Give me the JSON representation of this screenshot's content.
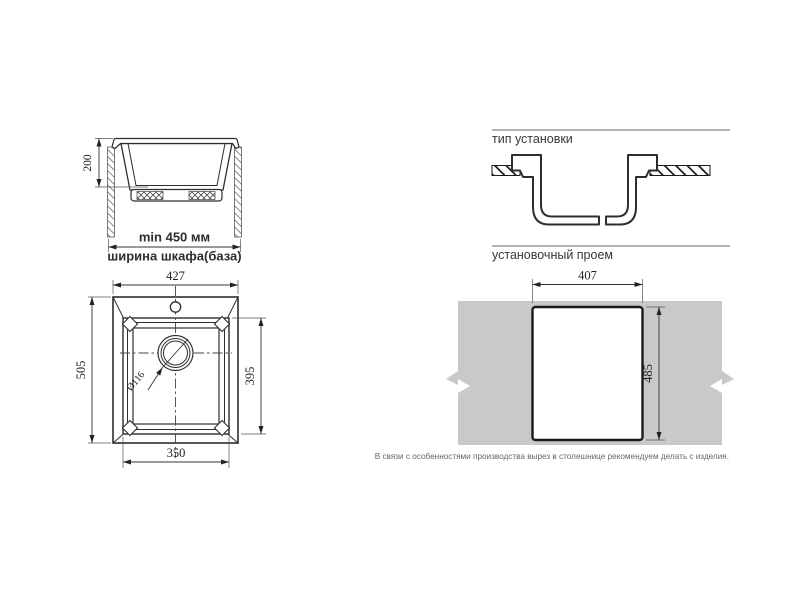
{
  "canvas": {
    "bg": "#ffffff",
    "line_color": "#2e2e2e",
    "rule_color": "#9a9a9a",
    "countertop_color": "#c9c9c9"
  },
  "side_view": {
    "depth": "200",
    "min_width": "min 450 мм",
    "cabinet_width": "ширина шкафа(база)"
  },
  "top_view": {
    "overall_width": "427",
    "overall_depth": "505",
    "bowl_depth_overall": "395",
    "bowl_width": "350",
    "drain_diameter": "Ø116"
  },
  "installation": {
    "heading": "тип установки"
  },
  "opening": {
    "heading": "установочный проем",
    "width": "407",
    "depth": "485",
    "note": "В связи с особенностями производства вырез в столешнице рекомендуем делать с изделия."
  }
}
